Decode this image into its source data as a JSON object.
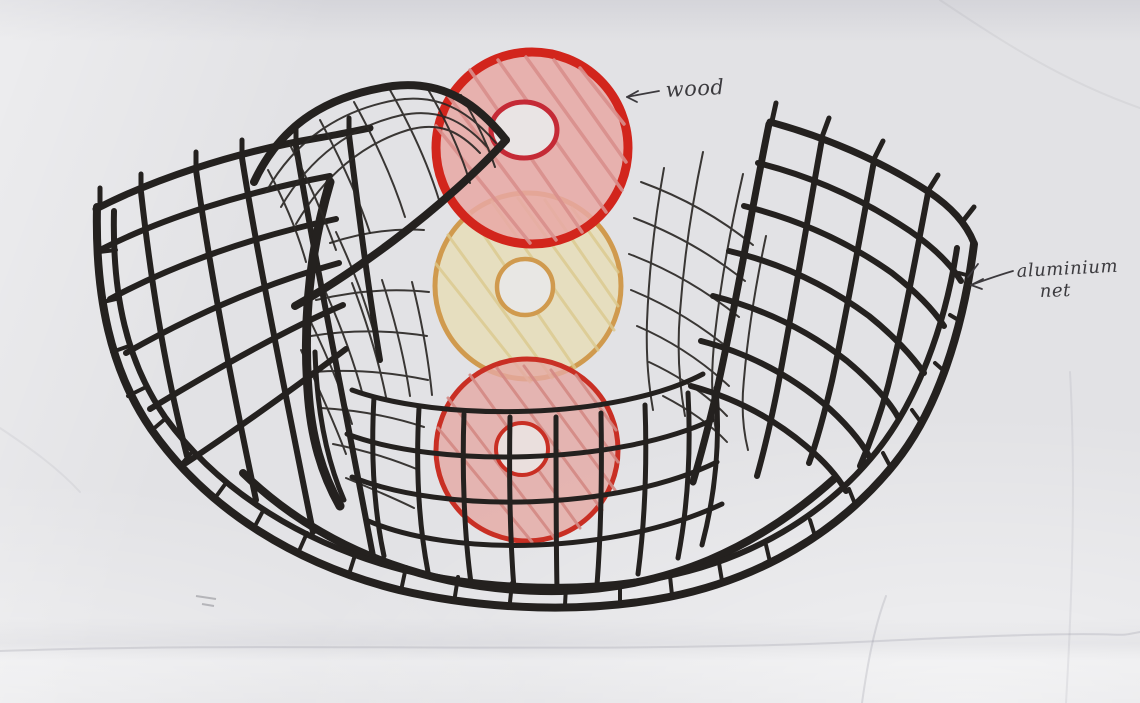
{
  "diagram": {
    "annotations": {
      "wood": {
        "label": "wood"
      },
      "aluminium_net": {
        "label_line1": "aluminium",
        "label_line2": "net"
      }
    },
    "colors": {
      "ink": "#24211f",
      "fine_ink": "#2b2825",
      "annotation_ink": "#3c3a3e",
      "top_disc_outline": "#d2251c",
      "top_disc_fill": "#e8a8a5",
      "top_disc_hatch": "#d98f8c",
      "top_disc_hole_ring": "#c52a36",
      "middle_disc_outline": "#d09a4e",
      "middle_disc_fill": "#e7dcb2",
      "middle_disc_hatch": "#dcc98e",
      "bottom_disc_outline": "#c92f24",
      "bottom_disc_fill": "#e5a9a4",
      "bottom_disc_hatch": "#d48984",
      "paper": "#e2e2e5"
    }
  }
}
